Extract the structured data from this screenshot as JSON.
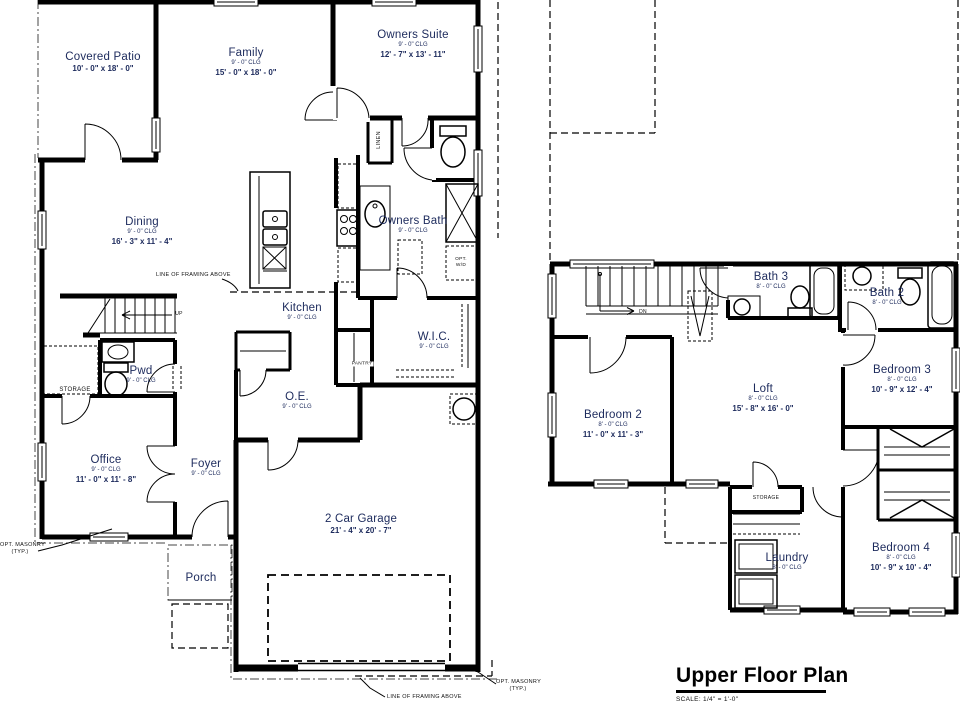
{
  "accent_color": "#1c2a5c",
  "first_floor": {
    "rooms": {
      "covered_patio": {
        "name": "Covered Patio",
        "dims": "10' - 0\" x 18' - 0\""
      },
      "family": {
        "name": "Family",
        "clg": "9' - 0\" CLG",
        "dims": "15' - 0\" x 18' - 0\""
      },
      "owners_suite": {
        "name": "Owners Suite",
        "clg": "9' - 0\" CLG",
        "dims": "12' - 7\" x 13' - 11\""
      },
      "dining": {
        "name": "Dining",
        "clg": "9' - 0\" CLG",
        "dims": "16' - 3\" x 11' - 4\""
      },
      "owners_bath": {
        "name": "Owners Bath",
        "clg": "9' - 0\" CLG"
      },
      "kitchen": {
        "name": "Kitchen",
        "clg": "9' - 0\" CLG"
      },
      "wic": {
        "name": "W.I.C.",
        "clg": "9' - 0\" CLG"
      },
      "pwd": {
        "name": "Pwd",
        "clg": "9' - 0\" CLG"
      },
      "oe": {
        "name": "O.E.",
        "clg": "9' - 0\" CLG"
      },
      "office": {
        "name": "Office",
        "clg": "9' - 0\" CLG",
        "dims": "11' - 0\" x 11' - 8\""
      },
      "foyer": {
        "name": "Foyer",
        "clg": "9' - 0\" CLG"
      },
      "porch": {
        "name": "Porch"
      },
      "garage": {
        "name": "2 Car Garage",
        "dims": "21' - 4\" x 20' - 7\""
      }
    },
    "annotations": {
      "linen": "LINEN",
      "pantry": "PANTRY",
      "storage": "STORAGE",
      "up": "UP",
      "opt_wd_line1": "OPT.",
      "opt_wd_line2": "W/D",
      "line_of_framing": "LINE OF FRAMING ABOVE",
      "opt_masonry": "OPT. MASONRY",
      "typ": "(TYP.)"
    }
  },
  "upper_floor": {
    "rooms": {
      "bath3": {
        "name": "Bath 3",
        "clg": "8' - 0\" CLG"
      },
      "bath2": {
        "name": "Bath 2",
        "clg": "8' - 0\" CLG"
      },
      "bedroom2": {
        "name": "Bedroom 2",
        "clg": "8' - 0\" CLG",
        "dims": "11' - 0\" x 11' - 3\""
      },
      "loft": {
        "name": "Loft",
        "clg": "8' - 0\" CLG",
        "dims": "15' - 8\" x 16' - 0\""
      },
      "bedroom3": {
        "name": "Bedroom 3",
        "clg": "8' - 0\" CLG",
        "dims": "10' - 9\" x 12' - 4\""
      },
      "bedroom4": {
        "name": "Bedroom 4",
        "clg": "8' - 0\" CLG",
        "dims": "10' - 9\" x 10' - 4\""
      },
      "laundry": {
        "name": "Laundry",
        "clg": "8' - 0\" CLG"
      }
    },
    "annotations": {
      "storage": "STORAGE",
      "dn": "DN"
    },
    "title": "Upper Floor Plan",
    "scale": "SCALE:  1/4\" = 1'-0\""
  }
}
